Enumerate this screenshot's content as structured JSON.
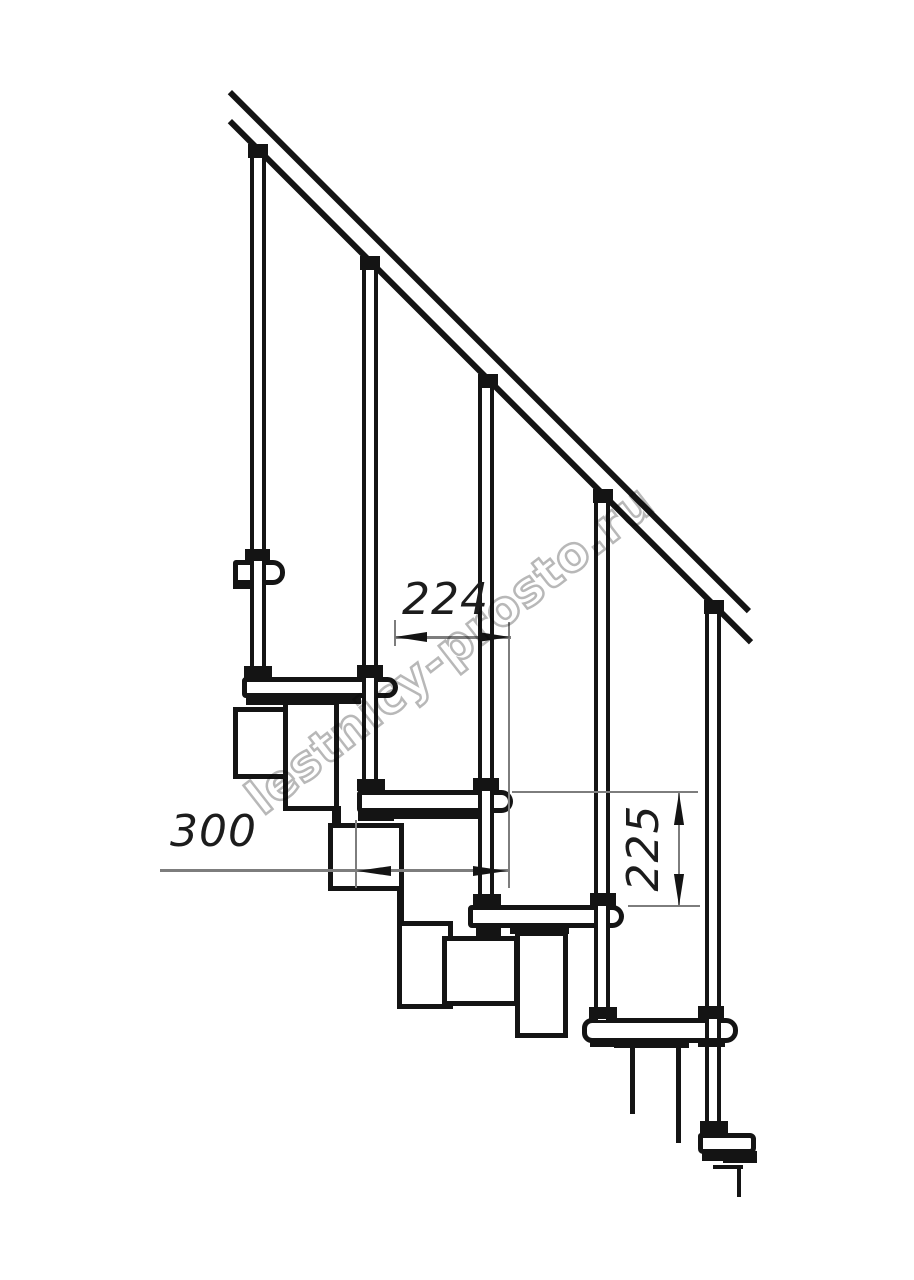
{
  "watermark": {
    "text": "lestnicy-prosto.ru",
    "color": "#b8b8b8"
  },
  "dimensions": {
    "run": {
      "label": "224",
      "orientation": "horizontal"
    },
    "module": {
      "label": "300",
      "orientation": "horizontal"
    },
    "rise": {
      "label": "225",
      "orientation": "vertical"
    }
  },
  "colors": {
    "line": "#141414",
    "thin_line": "#7d7d7d",
    "text": "#1c1c1c",
    "background": "#ffffff"
  },
  "geometry": {
    "rails": [
      {
        "name": "handrail-upper-line",
        "x": 232,
        "y": 90,
        "len": 734,
        "t": 6
      },
      {
        "name": "handrail-lower-line",
        "x": 232,
        "y": 119,
        "len": 737,
        "t": 6
      }
    ],
    "rects": [
      {
        "name": "support-module-a2",
        "cls": "box",
        "x": 233,
        "y": 707,
        "w": 58,
        "h": 72
      },
      {
        "name": "support-module-b2",
        "cls": "box",
        "x": 283,
        "y": 700,
        "w": 56,
        "h": 111
      },
      {
        "name": "module-neck-2-3",
        "cls": "solid",
        "x": 332,
        "y": 806,
        "w": 9,
        "h": 20
      },
      {
        "name": "support-module-a3",
        "cls": "box",
        "x": 328,
        "y": 823,
        "w": 76,
        "h": 68
      },
      {
        "name": "module-neck-3-4",
        "cls": "solid",
        "x": 397,
        "y": 886,
        "w": 7,
        "h": 38
      },
      {
        "name": "support-module-b3",
        "cls": "box",
        "x": 397,
        "y": 921,
        "w": 56,
        "h": 88
      },
      {
        "name": "support-module-a4",
        "cls": "box",
        "x": 442,
        "y": 936,
        "w": 77,
        "h": 70
      },
      {
        "name": "support-module-b4",
        "cls": "box",
        "x": 515,
        "y": 931,
        "w": 53,
        "h": 107
      },
      {
        "name": "module-cut-line-left",
        "cls": "solid",
        "x": 630,
        "y": 1046,
        "w": 5,
        "h": 68
      },
      {
        "name": "module-cut-line-right",
        "cls": "solid",
        "x": 676,
        "y": 1046,
        "w": 5,
        "h": 97
      },
      {
        "name": "tread-1",
        "cls": "box",
        "x": 233,
        "y": 560,
        "w": 52,
        "h": 25,
        "r": "3px 12px 12px 3px"
      },
      {
        "name": "tread-2",
        "cls": "box",
        "x": 242,
        "y": 677,
        "w": 156,
        "h": 21,
        "r": "4px 11px 11px 4px"
      },
      {
        "name": "tread-3",
        "cls": "box",
        "x": 357,
        "y": 790,
        "w": 156,
        "h": 23,
        "r": "4px 12px 12px 4px"
      },
      {
        "name": "tread-4",
        "cls": "box",
        "x": 468,
        "y": 905,
        "w": 156,
        "h": 23,
        "r": "4px 12px 12px 4px"
      },
      {
        "name": "tread-5",
        "cls": "box",
        "x": 582,
        "y": 1018,
        "w": 156,
        "h": 25,
        "r": "10px 12px 12px 10px"
      },
      {
        "name": "tread-6-floor-plate",
        "cls": "box",
        "x": 698,
        "y": 1133,
        "w": 58,
        "h": 21,
        "r": "3px 6px 6px 5px"
      },
      {
        "name": "baluster-rod-1",
        "cls": "rod",
        "x": 250,
        "y": 150,
        "w": 16,
        "h": 527
      },
      {
        "name": "baluster-rod-2",
        "cls": "rod",
        "x": 362,
        "y": 265,
        "w": 16,
        "h": 525
      },
      {
        "name": "baluster-rod-3",
        "cls": "rod",
        "x": 478,
        "y": 380,
        "w": 16,
        "h": 525
      },
      {
        "name": "baluster-rod-4",
        "cls": "rod",
        "x": 594,
        "y": 495,
        "w": 16,
        "h": 525
      },
      {
        "name": "baluster-rod-5",
        "cls": "rod",
        "x": 705,
        "y": 610,
        "w": 16,
        "h": 523
      },
      {
        "name": "tread-1-nub",
        "cls": "solid",
        "x": 233,
        "y": 580,
        "w": 17,
        "h": 9
      },
      {
        "name": "pad-under-tread-2",
        "cls": "solid",
        "x": 246,
        "y": 694,
        "w": 38,
        "h": 11
      },
      {
        "name": "strip-under-tread-2",
        "cls": "solid",
        "x": 277,
        "y": 695,
        "w": 84,
        "h": 9
      },
      {
        "name": "pad-under-tread-3",
        "cls": "solid",
        "x": 358,
        "y": 810,
        "w": 36,
        "h": 11
      },
      {
        "name": "strip-under-tread-3",
        "cls": "solid",
        "x": 392,
        "y": 811,
        "w": 87,
        "h": 8
      },
      {
        "name": "pad-under-tread-4",
        "cls": "solid",
        "x": 476,
        "y": 925,
        "w": 25,
        "h": 12
      },
      {
        "name": "strip-under-tread-4",
        "cls": "solid",
        "x": 510,
        "y": 926,
        "w": 59,
        "h": 8
      },
      {
        "name": "pad-under-tread-5-left",
        "cls": "solid",
        "x": 590,
        "y": 1038,
        "w": 26,
        "h": 9
      },
      {
        "name": "strip-under-tread-5",
        "cls": "solid",
        "x": 614,
        "y": 1039,
        "w": 75,
        "h": 9
      },
      {
        "name": "pad-under-tread-5-right",
        "cls": "solid",
        "x": 698,
        "y": 1038,
        "w": 27,
        "h": 9
      },
      {
        "name": "strip-under-floor-plate-a",
        "cls": "solid",
        "x": 702,
        "y": 1152,
        "w": 21,
        "h": 9
      },
      {
        "name": "strip-under-floor-plate-b",
        "cls": "solid",
        "x": 723,
        "y": 1151,
        "w": 34,
        "h": 12
      },
      {
        "name": "floor-cut-line-h",
        "cls": "solid",
        "x": 713,
        "y": 1165,
        "w": 30,
        "h": 4
      },
      {
        "name": "floor-cut-line-v",
        "cls": "solid",
        "x": 737,
        "y": 1165,
        "w": 4,
        "h": 32
      },
      {
        "name": "baluster-washer-tread-1",
        "cls": "solid",
        "x": 245,
        "y": 549,
        "w": 25,
        "h": 12
      },
      {
        "name": "baluster-washer-tread-2",
        "cls": "solid",
        "x": 357,
        "y": 665,
        "w": 26,
        "h": 13
      },
      {
        "name": "baluster-washer-tread-3",
        "cls": "solid",
        "x": 473,
        "y": 778,
        "w": 26,
        "h": 13
      },
      {
        "name": "baluster-washer-tread-4",
        "cls": "solid",
        "x": 590,
        "y": 893,
        "w": 26,
        "h": 13
      },
      {
        "name": "baluster-washer-tread-5",
        "cls": "solid",
        "x": 698,
        "y": 1006,
        "w": 26,
        "h": 13
      },
      {
        "name": "baluster-foot-1",
        "cls": "solid",
        "x": 244,
        "y": 666,
        "w": 28,
        "h": 12
      },
      {
        "name": "baluster-foot-2",
        "cls": "solid",
        "x": 357,
        "y": 779,
        "w": 28,
        "h": 12
      },
      {
        "name": "baluster-foot-3",
        "cls": "solid",
        "x": 473,
        "y": 894,
        "w": 28,
        "h": 12
      },
      {
        "name": "baluster-foot-4",
        "cls": "solid",
        "x": 589,
        "y": 1007,
        "w": 28,
        "h": 12
      },
      {
        "name": "baluster-foot-5",
        "cls": "solid",
        "x": 700,
        "y": 1121,
        "w": 28,
        "h": 13
      },
      {
        "name": "baluster-rail-cap-1",
        "cls": "solid",
        "x": 248,
        "y": 144,
        "w": 20,
        "h": 14
      },
      {
        "name": "baluster-rail-cap-2",
        "cls": "solid",
        "x": 360,
        "y": 256,
        "w": 20,
        "h": 14
      },
      {
        "name": "baluster-rail-cap-3",
        "cls": "solid",
        "x": 478,
        "y": 374,
        "w": 20,
        "h": 14
      },
      {
        "name": "baluster-rail-cap-4",
        "cls": "solid",
        "x": 593,
        "y": 489,
        "w": 20,
        "h": 14
      },
      {
        "name": "baluster-rail-cap-5",
        "cls": "solid",
        "x": 704,
        "y": 600,
        "w": 20,
        "h": 14
      },
      {
        "name": "ext-line-run-left",
        "cls": "thin",
        "x": 394,
        "y": 620,
        "w": 2,
        "h": 26
      },
      {
        "name": "ext-line-run-right",
        "cls": "thin",
        "x": 508,
        "y": 622,
        "w": 2,
        "h": 266
      },
      {
        "name": "dim-line-run",
        "cls": "thin",
        "x": 395,
        "y": 636,
        "w": 116,
        "h": 3
      },
      {
        "name": "dim-line-module",
        "cls": "thin",
        "x": 160,
        "y": 869,
        "w": 348,
        "h": 3
      },
      {
        "name": "center-line-module",
        "cls": "thin",
        "x": 355,
        "y": 820,
        "w": 2,
        "h": 68
      },
      {
        "name": "ext-line-rise-top",
        "cls": "thin",
        "x": 512,
        "y": 791,
        "w": 186,
        "h": 2
      },
      {
        "name": "ext-line-rise-bottom",
        "cls": "thin",
        "x": 628,
        "y": 905,
        "w": 72,
        "h": 2
      },
      {
        "name": "dim-line-rise",
        "cls": "thin",
        "x": 678,
        "y": 793,
        "w": 2,
        "h": 114
      },
      {
        "name": "arrow-run-left",
        "cls": "solid",
        "dir": "left",
        "x": 395,
        "y": 631,
        "w": 32,
        "h": 12
      },
      {
        "name": "arrow-run-right",
        "cls": "solid",
        "dir": "right",
        "x": 478,
        "y": 631,
        "w": 32,
        "h": 12
      },
      {
        "name": "arrow-module-left",
        "cls": "solid",
        "dir": "left",
        "x": 357,
        "y": 865,
        "w": 34,
        "h": 12
      },
      {
        "name": "arrow-module-right",
        "cls": "solid",
        "dir": "right",
        "x": 473,
        "y": 865,
        "w": 34,
        "h": 12
      },
      {
        "name": "arrow-rise-up",
        "cls": "solid",
        "dir": "up",
        "x": 673,
        "y": 793,
        "w": 12,
        "h": 32
      },
      {
        "name": "arrow-rise-down",
        "cls": "solid",
        "dir": "down",
        "x": 673,
        "y": 874,
        "w": 12,
        "h": 32
      }
    ]
  }
}
